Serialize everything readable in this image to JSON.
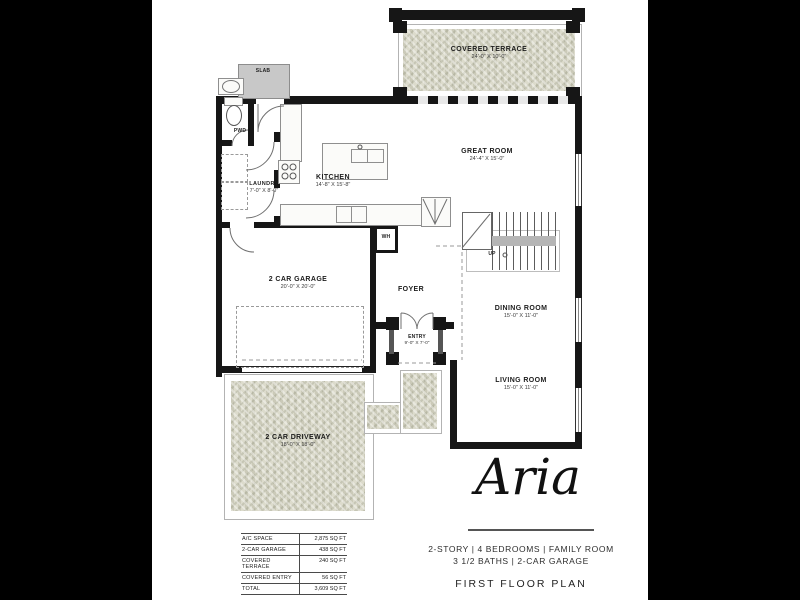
{
  "plan": {
    "brand": "Aria",
    "title": "FIRST FLOOR PLAN",
    "spec_line1": "2-STORY  |  4 BEDROOMS  | FAMILY ROOM",
    "spec_line2": "3 1/2 BATHS  |  2-CAR GARAGE"
  },
  "rooms": {
    "covered_terrace": {
      "name": "COVERED TERRACE",
      "dims": "24'-0\" X 10'-0\""
    },
    "great_room": {
      "name": "GREAT ROOM",
      "dims": "24'-4\" X 15'-0\""
    },
    "kitchen": {
      "name": "KITCHEN",
      "dims": "14'-8\" X 15'-8\""
    },
    "laundry": {
      "name": "LAUNDRY",
      "dims": "7'-0\" X 8'-0\""
    },
    "pwd": {
      "name": "PWD"
    },
    "slab": {
      "name": "SLAB"
    },
    "wh": {
      "name": "WH"
    },
    "up": {
      "name": "UP"
    },
    "foyer": {
      "name": "FOYER"
    },
    "entry": {
      "name": "ENTRY",
      "dims": "9'-0\" X 7'-0\""
    },
    "garage": {
      "name": "2 CAR GARAGE",
      "dims": "20'-0\" X 20'-0\""
    },
    "dining_room": {
      "name": "DINING ROOM",
      "dims": "15'-0\" X 11'-0\""
    },
    "living_room": {
      "name": "LIVING ROOM",
      "dims": "15'-0\" X 11'-0\""
    },
    "driveway": {
      "name": "2 CAR DRIVEWAY",
      "dims": "18'-0\" X 18'-0\""
    }
  },
  "summary": {
    "rows": [
      {
        "label": "A/C SPACE",
        "value": "2,875 SQ FT"
      },
      {
        "label": "2-CAR GARAGE",
        "value": "438 SQ FT"
      },
      {
        "label": "COVERED TERRACE",
        "value": "240 SQ FT"
      },
      {
        "label": "COVERED ENTRY",
        "value": "56 SQ FT"
      },
      {
        "label": "TOTAL",
        "value": "3,609 SQ FT"
      }
    ]
  },
  "colors": {
    "background": "#000000",
    "page": "#ffffff",
    "wall": "#161616",
    "terrace_texture": "#d7d6c5",
    "slab_fill": "#c8c8c8"
  }
}
